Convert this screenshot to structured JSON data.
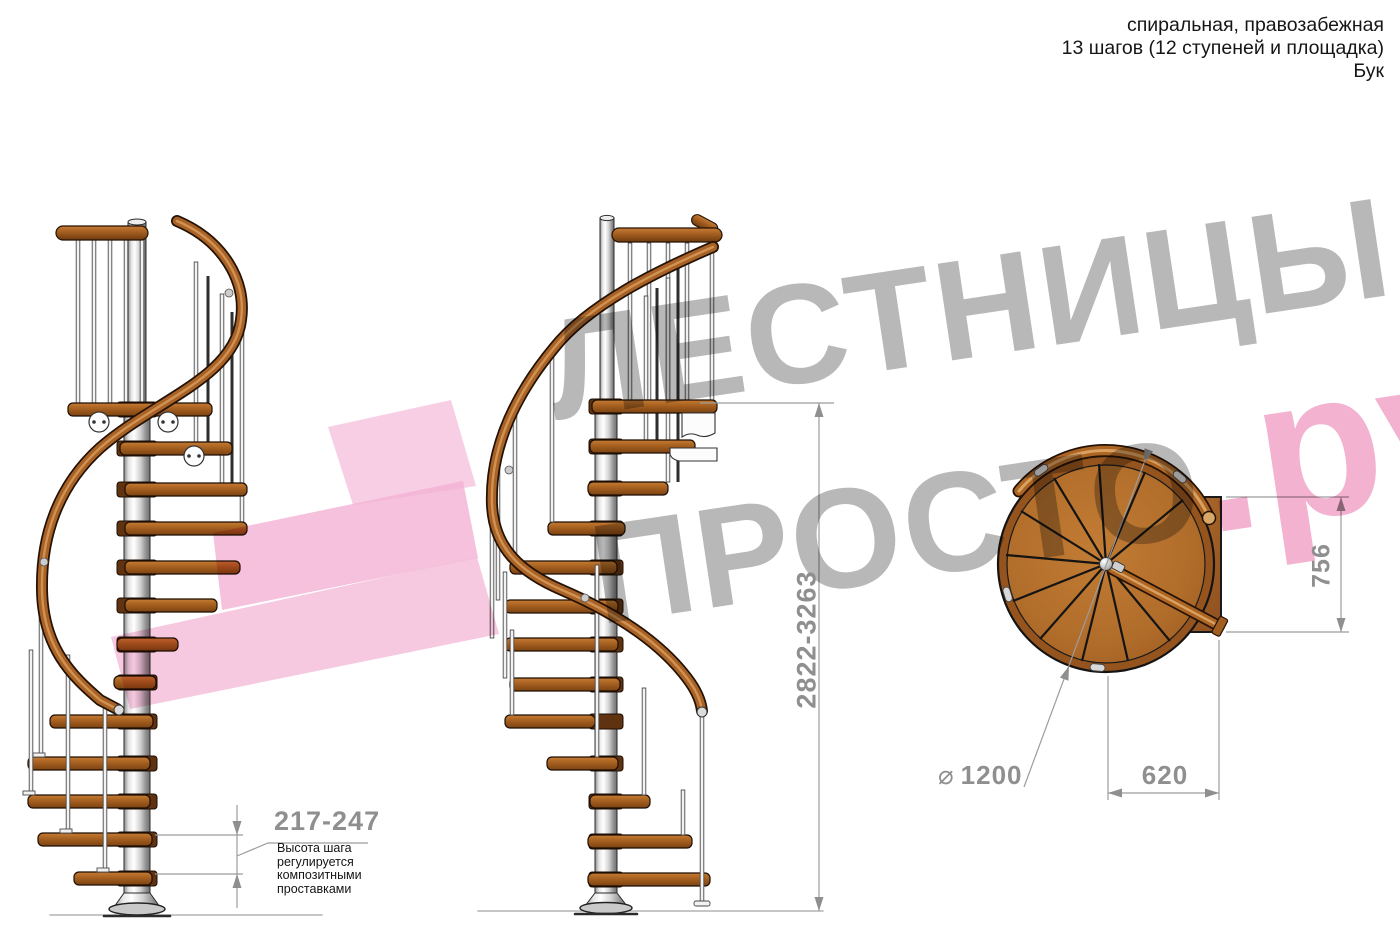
{
  "header": {
    "line1": "спиральная, правозабежная",
    "line2": "13 шагов (12 ступеней и площадка)",
    "line3": "Бук"
  },
  "watermark": {
    "line1": "ЛЕСТНИЦЫ",
    "line2": "ПРОСТО",
    "suffix": ".ру"
  },
  "dimensions": {
    "total_height": "2822-3263",
    "step_height": "217-247",
    "step_note": "Высота шага\nрегулируется\nкомпозитными\nпроставками",
    "diameter_symbol": "⌀",
    "diameter": "1200",
    "landing_width": "620",
    "landing_depth": "756"
  },
  "colors": {
    "watermark_gray": "#a9a9a9",
    "watermark_pink": "#f0a1c6",
    "arrow_pink": "#f3b3d6",
    "wood": "#a96226",
    "steel": "#d9d9d9",
    "dimension_gray": "#8f8f8f",
    "text_black": "#161616"
  },
  "views": {
    "side_a": "вид сбоку 1",
    "side_b": "вид сбоку 2",
    "top": "вид сверху"
  }
}
